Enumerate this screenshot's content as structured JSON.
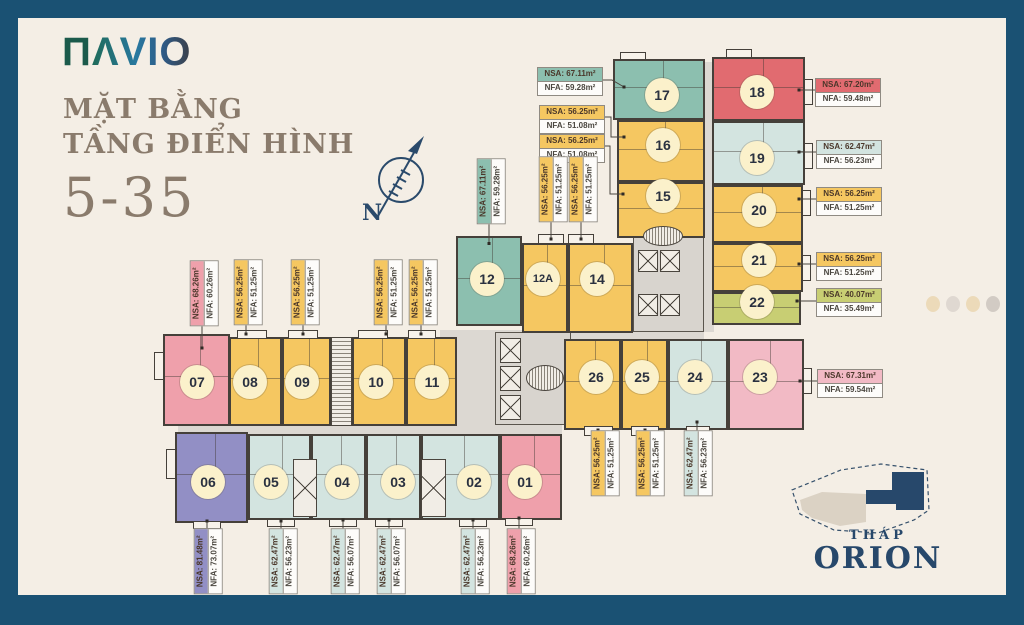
{
  "colors": {
    "frame": "#1A5173",
    "background": "#F4EEE5",
    "badge_bg": "#FBF1CB",
    "navy": "#27486B",
    "yellow": "#F5C761",
    "teal": "#8CBFAF",
    "red": "#E16B70",
    "pink": "#EFA0AB",
    "rose": "#F2BAC5",
    "blue": "#D3E4E0",
    "purple": "#928FC5",
    "lime": "#C8CE73"
  },
  "logo": {
    "mark": "Π",
    "name": "ΛVIO"
  },
  "title": {
    "line1": "MẶT BẰNG",
    "line2": "TẦNG ĐIỂN HÌNH",
    "line3": "5-35"
  },
  "compass": {
    "label": "N"
  },
  "minimap": {
    "label_small": "THÁP",
    "label_large": "ORION"
  },
  "units": [
    {
      "id": "01",
      "nsa": "NSA: 68.26m²",
      "nfa": "NFA: 60.26m²",
      "fill": "#EFA0AB"
    },
    {
      "id": "02",
      "nsa": "NSA: 62.47m²",
      "nfa": "NFA: 56.23m²",
      "fill": "#D3E4E0"
    },
    {
      "id": "03",
      "nsa": "NSA: 62.47m²",
      "nfa": "NFA: 56.07m²",
      "fill": "#D3E4E0"
    },
    {
      "id": "04",
      "nsa": "NSA: 62.47m²",
      "nfa": "NFA: 56.07m²",
      "fill": "#D3E4E0"
    },
    {
      "id": "05",
      "nsa": "NSA: 62.47m²",
      "nfa": "NFA: 56.23m²",
      "fill": "#D3E4E0"
    },
    {
      "id": "06",
      "nsa": "NSA: 81.48m²",
      "nfa": "NFA: 73.07m²",
      "fill": "#928FC5"
    },
    {
      "id": "07",
      "nsa": "NSA: 68.26m²",
      "nfa": "NFA: 60.26m²",
      "fill": "#EFA0AB"
    },
    {
      "id": "08",
      "nsa": "NSA: 56.25m²",
      "nfa": "NFA: 51.25m²",
      "fill": "#F5C761"
    },
    {
      "id": "09",
      "nsa": "NSA: 56.25m²",
      "nfa": "NFA: 51.25m²",
      "fill": "#F5C761"
    },
    {
      "id": "10",
      "nsa": "NSA: 56.25m²",
      "nfa": "NFA: 51.25m²",
      "fill": "#F5C761"
    },
    {
      "id": "11",
      "nsa": "NSA: 56.25m²",
      "nfa": "NFA: 51.25m²",
      "fill": "#F5C761"
    },
    {
      "id": "12",
      "nsa": "NSA: 67.11m²",
      "nfa": "NFA: 59.28m²",
      "fill": "#8CBFAF"
    },
    {
      "id": "12A",
      "nsa": "NSA: 56.25m²",
      "nfa": "NFA: 51.25m²",
      "fill": "#F5C761"
    },
    {
      "id": "14",
      "nsa": "NSA: 56.25m²",
      "nfa": "NFA: 51.25m²",
      "fill": "#F5C761"
    },
    {
      "id": "15",
      "nsa": "NSA: 56.25m²",
      "nfa": "NFA: 51.08m²",
      "fill": "#F5C761"
    },
    {
      "id": "16",
      "nsa": "NSA: 56.25m²",
      "nfa": "NFA: 51.08m²",
      "fill": "#F5C761"
    },
    {
      "id": "17",
      "nsa": "NSA: 67.11m²",
      "nfa": "NFA: 59.28m²",
      "fill": "#8CBFAF"
    },
    {
      "id": "18",
      "nsa": "NSA: 67.20m²",
      "nfa": "NFA: 59.48m²",
      "fill": "#E16B70"
    },
    {
      "id": "19",
      "nsa": "NSA: 62.47m²",
      "nfa": "NFA: 56.23m²",
      "fill": "#D3E4E0"
    },
    {
      "id": "20",
      "nsa": "NSA: 56.25m²",
      "nfa": "NFA: 51.25m²",
      "fill": "#F5C761"
    },
    {
      "id": "21",
      "nsa": "NSA: 56.25m²",
      "nfa": "NFA: 51.25m²",
      "fill": "#F5C761"
    },
    {
      "id": "22",
      "nsa": "NSA: 40.07m²",
      "nfa": "NFA: 35.49m²",
      "fill": "#C8CE73"
    },
    {
      "id": "23",
      "nsa": "NSA: 67.31m²",
      "nfa": "NFA: 59.54m²",
      "fill": "#F2BAC5"
    },
    {
      "id": "24",
      "nsa": "NSA: 62.47m²",
      "nfa": "NFA: 56.23m²",
      "fill": "#D3E4E0"
    },
    {
      "id": "25",
      "nsa": "NSA: 56.25m²",
      "nfa": "NFA: 51.25m²",
      "fill": "#F5C761"
    },
    {
      "id": "26",
      "nsa": "NSA: 56.25m²",
      "nfa": "NFA: 51.25m²",
      "fill": "#F5C761"
    }
  ]
}
